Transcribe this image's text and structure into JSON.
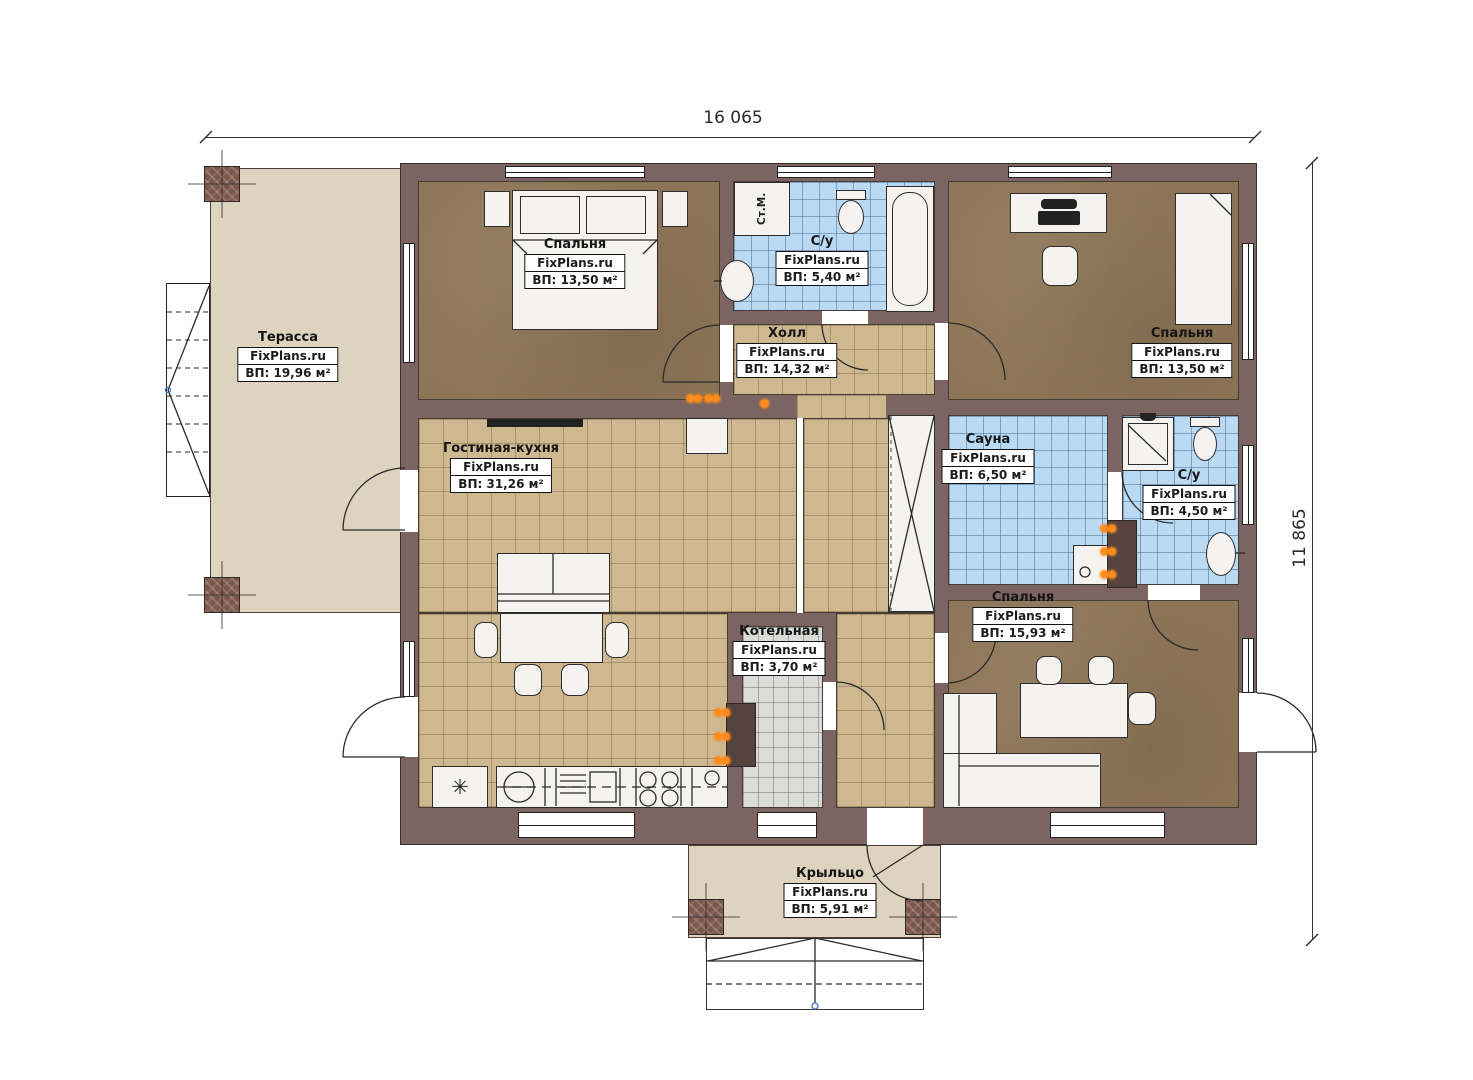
{
  "plan": {
    "dimension_top": "16 065",
    "dimension_right": "11 865"
  },
  "rooms": {
    "terrace": {
      "name": "Терасса",
      "brand": "FixPlans.ru",
      "area": "ВП: 19,96 м²"
    },
    "bedroom_top_left": {
      "name": "Спальня",
      "brand": "FixPlans.ru",
      "area": "ВП: 13,50 м²"
    },
    "bathroom_top": {
      "name": "С/у",
      "brand": "FixPlans.ru",
      "area": "ВП: 5,40 м²"
    },
    "hall": {
      "name": "Холл",
      "brand": "FixPlans.ru",
      "area": "ВП: 14,32 м²"
    },
    "bedroom_top_right": {
      "name": "Спальня",
      "brand": "FixPlans.ru",
      "area": "ВП: 13,50 м²"
    },
    "living_kitchen": {
      "name": "Гостиная-кухня",
      "brand": "FixPlans.ru",
      "area": "ВП: 31,26 м²"
    },
    "sauna": {
      "name": "Сауна",
      "brand": "FixPlans.ru",
      "area": "ВП: 6,50 м²"
    },
    "bathroom_right": {
      "name": "С/у",
      "brand": "FixPlans.ru",
      "area": "ВП: 4,50 м²"
    },
    "bedroom_bottom_right": {
      "name": "Спальня",
      "brand": "FixPlans.ru",
      "area": "ВП: 15,93 м²"
    },
    "boiler": {
      "name": "Котельная",
      "brand": "FixPlans.ru",
      "area": "ВП: 3,70 м²"
    },
    "porch": {
      "name": "Крыльцо",
      "brand": "FixPlans.ru",
      "area": "ВП: 5,91 м²"
    }
  },
  "appliances": {
    "washing_machine": "Ст.М.",
    "fridge_symbol": "✳"
  },
  "colors": {
    "wall": "#7b6462",
    "floor_tile_tan": "#cdb890",
    "floor_tile_blue": "#badaf4",
    "floor_brown": "#8d7557",
    "floor_beige": "#ded3bf",
    "flame_orange": "#ff8c1a"
  }
}
